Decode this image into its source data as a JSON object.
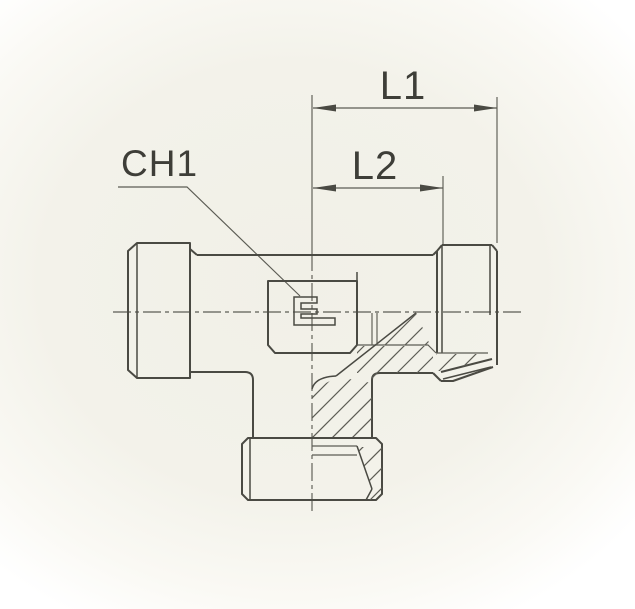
{
  "labels": {
    "l1": "L1",
    "l2": "L2",
    "ch1": "CH1"
  },
  "colors": {
    "line": "#4a4a43",
    "thin": "#5c5c54",
    "label": "#3e3e38",
    "paper": "#f1f0e7",
    "page": "#ffffff"
  }
}
